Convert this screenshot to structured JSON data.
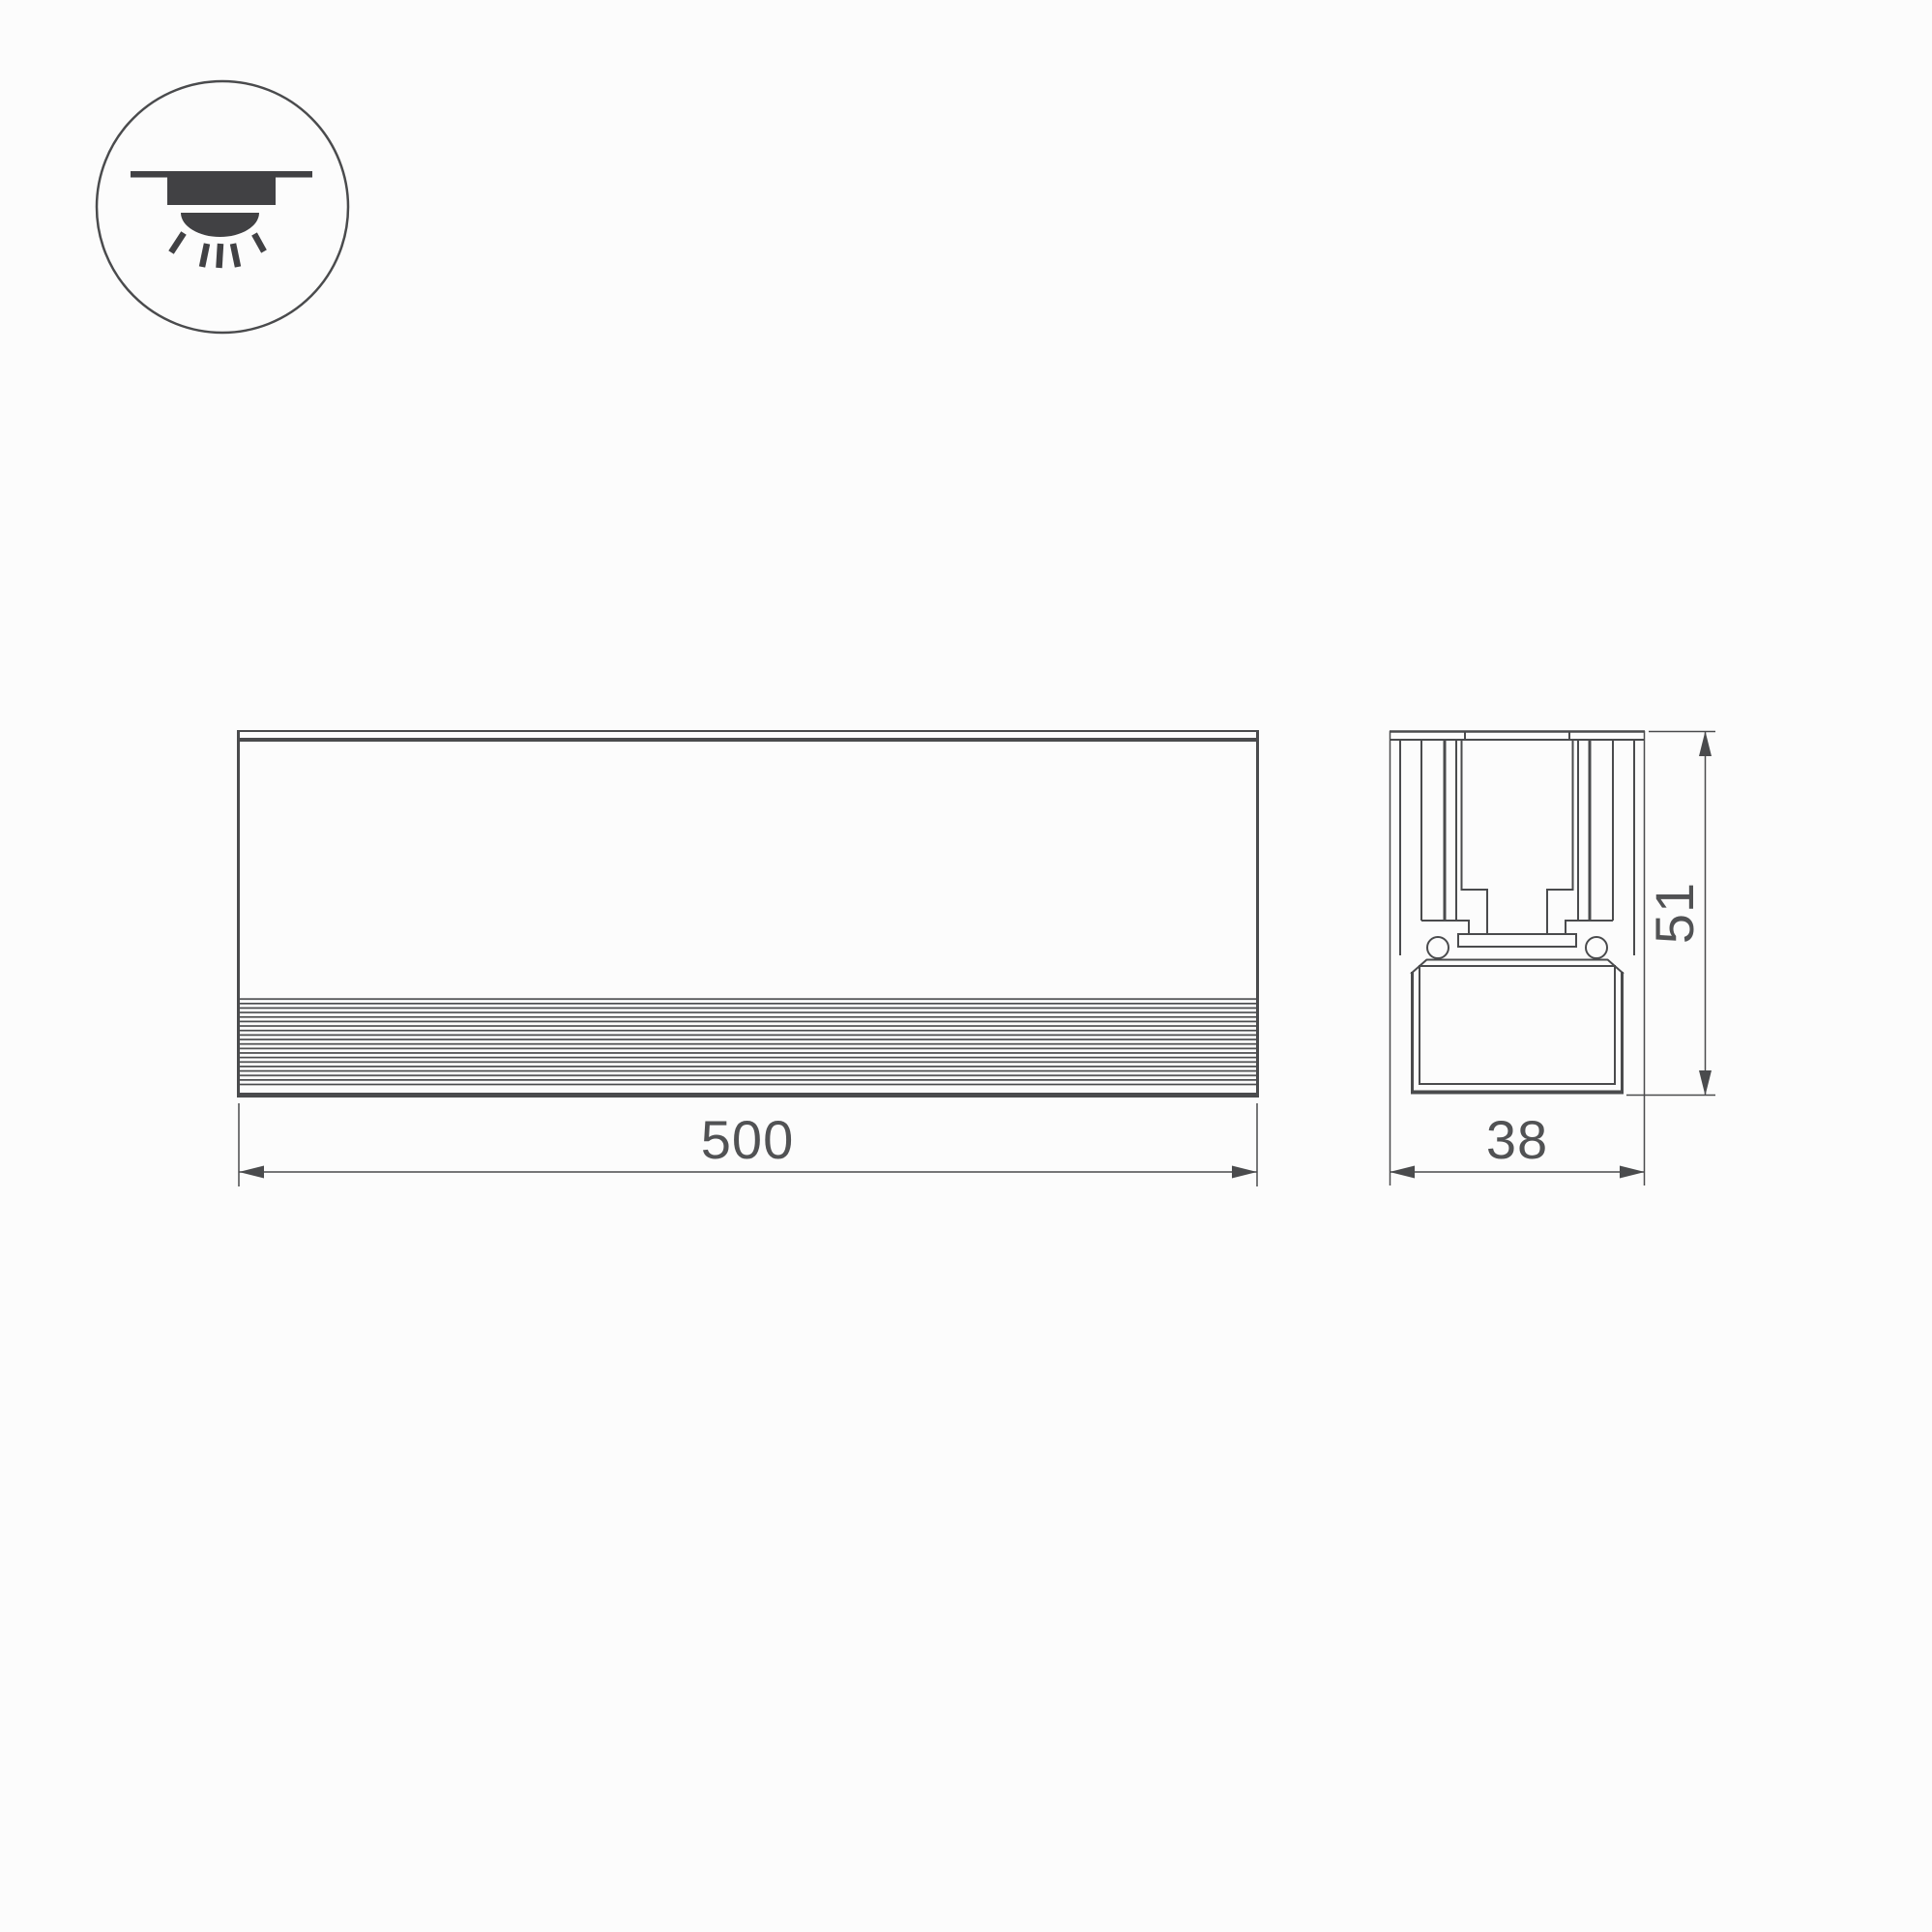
{
  "canvas": {
    "background": "#fcfcfc",
    "line_color": "#4a4b4d",
    "text_color": "#515254"
  },
  "icon": {
    "name": "recessed-downlight-icon"
  },
  "dimensions": {
    "length": "500",
    "width": "38",
    "height": "51"
  }
}
